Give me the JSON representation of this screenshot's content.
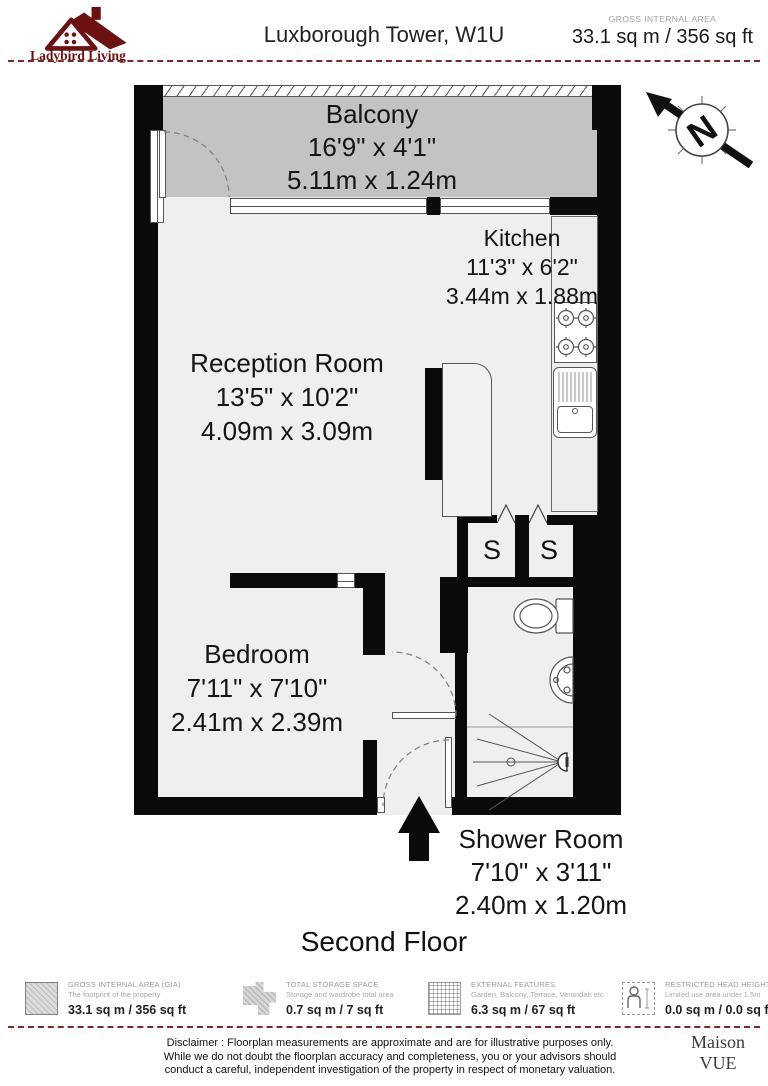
{
  "header": {
    "brand": "Ladybird Living",
    "title": "Luxborough Tower, W1U",
    "gia_label": "GROSS INTERNAL AREA",
    "gia_value": "33.1 sq m / 356 sq ft"
  },
  "compass_label": "N",
  "rooms": {
    "balcony": {
      "name": "Balcony",
      "imperial": "16'9\" x 4'1\"",
      "metric": "5.11m x 1.24m"
    },
    "kitchen": {
      "name": "Kitchen",
      "imperial": "11'3\" x 6'2\"",
      "metric": "3.44m x 1.88m"
    },
    "reception": {
      "name": "Reception Room",
      "imperial": "13'5\" x 10'2\"",
      "metric": "4.09m x 3.09m"
    },
    "bedroom": {
      "name": "Bedroom",
      "imperial": "7'11\" x 7'10\"",
      "metric": "2.41m x 2.39m"
    },
    "shower": {
      "name": "Shower Room",
      "imperial": "7'10\" x 3'11\"",
      "metric": "2.40m x 1.20m"
    },
    "storage_label": "S"
  },
  "floor_label": "Second Floor",
  "legend": [
    {
      "title": "GROSS INTERNAL AREA (GIA)",
      "subtitle": "The footprint of the property",
      "value": "33.1 sq m / 356 sq ft",
      "icon": "hatched-square-icon"
    },
    {
      "title": "TOTAL STORAGE SPACE",
      "subtitle": "Storage and wardrobe total area",
      "value": "0.7 sq m / 7 sq ft",
      "icon": "storage-shape-icon"
    },
    {
      "title": "EXTERNAL FEATURES",
      "subtitle": "Garden, Balcony, Terrace, Verandah etc.",
      "value": "6.3 sq m / 67 sq ft",
      "icon": "grid-square-icon"
    },
    {
      "title": "RESTRICTED HEAD HEIGHT",
      "subtitle": "Limited use area under 1.5m",
      "value": "0.0 sq m / 0.0 sq ft",
      "icon": "person-height-icon"
    }
  ],
  "disclaimer": {
    "line1": "Disclaimer : Floorplan measurements are approximate and are for illustrative purposes only.",
    "line2": "While we do not doubt the floorplan accuracy and completeness, you or your advisors should",
    "line3": "conduct a careful, independent investigation of the property in respect of monetary valuation."
  },
  "footer_brand": {
    "line1": "Maison",
    "line2": "VUE"
  },
  "colors": {
    "wall": "#0a0a0a",
    "balcony_fill": "#c3c3c3",
    "floor_fill": "#efefef",
    "brand_maroon": "#6b1111",
    "dashed_separator": "#7a2a24",
    "legend_gray": "#9a9a9a"
  }
}
